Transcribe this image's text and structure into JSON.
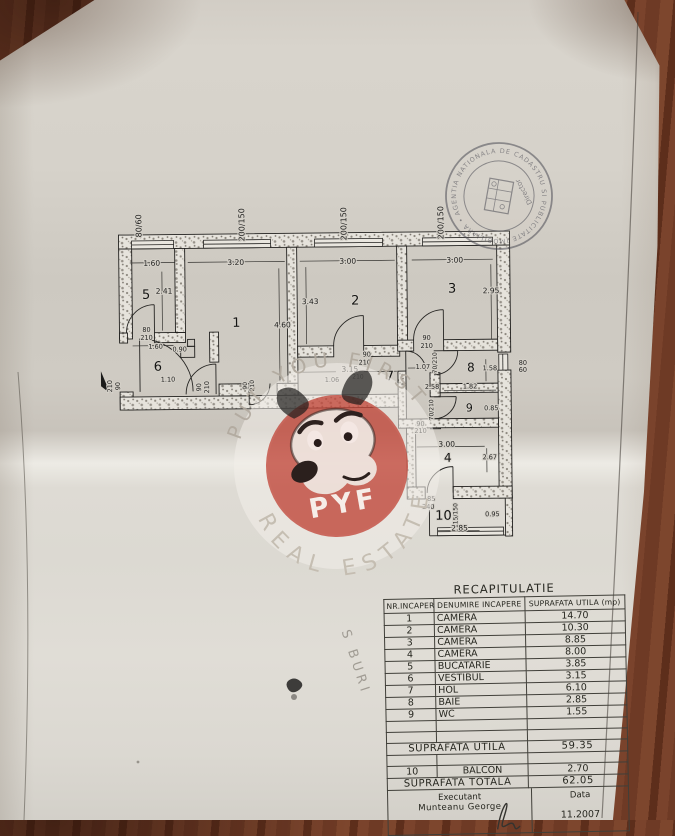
{
  "plan": {
    "labels": [
      {
        "t": "80/60",
        "x": 143,
        "y": 224,
        "r": -90,
        "s": 8
      },
      {
        "t": "200/150",
        "x": 246,
        "y": 224,
        "r": -90,
        "s": 8
      },
      {
        "t": "200/150",
        "x": 348,
        "y": 224,
        "r": -90,
        "s": 8
      },
      {
        "t": "200/150",
        "x": 445,
        "y": 224,
        "r": -90,
        "s": 8
      },
      {
        "t": "5",
        "x": 147,
        "y": 297,
        "s": 13,
        "cls": "num"
      },
      {
        "t": "1",
        "x": 237,
        "y": 326,
        "s": 13,
        "cls": "num"
      },
      {
        "t": "2",
        "x": 356,
        "y": 305,
        "s": 13,
        "cls": "num"
      },
      {
        "t": "3",
        "x": 453,
        "y": 294,
        "s": 13,
        "cls": "num"
      },
      {
        "t": "6",
        "x": 158,
        "y": 369,
        "s": 13,
        "cls": "num"
      },
      {
        "t": "7",
        "x": 390,
        "y": 381,
        "s": 13,
        "cls": "num"
      },
      {
        "t": "8",
        "x": 471,
        "y": 373,
        "s": 12,
        "cls": "num"
      },
      {
        "t": "9",
        "x": 469,
        "y": 413,
        "s": 11,
        "cls": "num"
      },
      {
        "t": "4",
        "x": 447,
        "y": 463,
        "s": 12,
        "cls": "num"
      },
      {
        "t": "10",
        "x": 442,
        "y": 521,
        "s": 13,
        "cls": "num"
      },
      {
        "t": "1.60",
        "x": 153,
        "y": 264
      },
      {
        "t": "3.20",
        "x": 237,
        "y": 264
      },
      {
        "t": "3.00",
        "x": 349,
        "y": 264
      },
      {
        "t": "3.00",
        "x": 456,
        "y": 264
      },
      {
        "t": "2.41",
        "x": 165,
        "y": 292
      },
      {
        "t": "4.60",
        "x": 283,
        "y": 327
      },
      {
        "t": "3.43",
        "x": 311,
        "y": 304
      },
      {
        "t": "2.95",
        "x": 492,
        "y": 295
      },
      {
        "t": "80",
        "x": 147,
        "y": 330,
        "s": 6.5
      },
      {
        "t": "210",
        "x": 147,
        "y": 338,
        "s": 6.5
      },
      {
        "t": "1.60",
        "x": 156,
        "y": 347,
        "s": 6.5
      },
      {
        "t": "0.90",
        "x": 180,
        "y": 350,
        "s": 6.5
      },
      {
        "t": "1.10",
        "x": 168,
        "y": 380,
        "s": 6.5
      },
      {
        "t": "90",
        "x": 120,
        "y": 384,
        "r": -90,
        "s": 6.5
      },
      {
        "t": "210",
        "x": 112,
        "y": 384,
        "r": -90,
        "s": 6.5
      },
      {
        "t": "90",
        "x": 201,
        "y": 386,
        "r": -90,
        "s": 6.5
      },
      {
        "t": "210",
        "x": 209,
        "y": 386,
        "r": -90,
        "s": 6.5
      },
      {
        "t": "90",
        "x": 247,
        "y": 385,
        "r": -90,
        "s": 6
      },
      {
        "t": "210",
        "x": 254,
        "y": 385,
        "r": -90,
        "s": 6
      },
      {
        "t": "3.15",
        "x": 350,
        "y": 372
      },
      {
        "t": "210",
        "x": 358,
        "y": 379,
        "s": 6
      },
      {
        "t": "1.06",
        "x": 332,
        "y": 382,
        "s": 6.5
      },
      {
        "t": "90",
        "x": 367,
        "y": 357,
        "s": 6.5
      },
      {
        "t": "210",
        "x": 365,
        "y": 365,
        "s": 6.5
      },
      {
        "t": "1.07",
        "x": 423,
        "y": 370,
        "s": 6.5
      },
      {
        "t": "2.58",
        "x": 432,
        "y": 390,
        "s": 6.5
      },
      {
        "t": "90",
        "x": 427,
        "y": 341,
        "s": 6.5
      },
      {
        "t": "210",
        "x": 427,
        "y": 349,
        "s": 6.5
      },
      {
        "t": "70/210",
        "x": 437,
        "y": 364,
        "r": -90,
        "s": 6
      },
      {
        "t": "1.58",
        "x": 490,
        "y": 372,
        "s": 6.5
      },
      {
        "t": "1.82",
        "x": 470,
        "y": 390,
        "s": 6.5
      },
      {
        "t": "80",
        "x": 523,
        "y": 367,
        "s": 6.5
      },
      {
        "t": "60",
        "x": 523,
        "y": 374,
        "s": 6.5
      },
      {
        "t": "0.85",
        "x": 491,
        "y": 412,
        "s": 6.5
      },
      {
        "t": "70/210",
        "x": 433,
        "y": 411,
        "r": -90,
        "s": 6
      },
      {
        "t": "90",
        "x": 420,
        "y": 427,
        "s": 6.5
      },
      {
        "t": "210",
        "x": 420,
        "y": 434,
        "s": 6.5
      },
      {
        "t": "3.00",
        "x": 446,
        "y": 448
      },
      {
        "t": "2.67",
        "x": 489,
        "y": 461,
        "s": 6.5
      },
      {
        "t": "85",
        "x": 430,
        "y": 502,
        "s": 6.5
      },
      {
        "t": "240",
        "x": 427,
        "y": 510,
        "s": 6.5
      },
      {
        "t": "115/150",
        "x": 456,
        "y": 517,
        "r": -90,
        "s": 6
      },
      {
        "t": "0.95",
        "x": 491,
        "y": 518,
        "s": 6.5
      },
      {
        "t": "2.85",
        "x": 458,
        "y": 532
      }
    ]
  },
  "table": {
    "title": "RECAPITULATIE",
    "headers": [
      "NR.INCAPERE",
      "DENUMIRE INCAPERE",
      "SUPRAFATA UTILA (mp)"
    ],
    "rows": [
      [
        "1",
        "CAMERA",
        "14.70"
      ],
      [
        "2",
        "CAMERA",
        "10.30"
      ],
      [
        "3",
        "CAMERA",
        "8.85"
      ],
      [
        "4",
        "CAMERA",
        "8.00"
      ],
      [
        "5",
        "BUCATARIE",
        "3.85"
      ],
      [
        "6",
        "VESTIBUL",
        "3.15"
      ],
      [
        "7",
        "HOL",
        "6.10"
      ],
      [
        "8",
        "BAIE",
        "2.85"
      ],
      [
        "9",
        "WC",
        "1.55"
      ]
    ],
    "subtotal_label": "SUPRAFATA UTILA",
    "subtotal_value": "59.35",
    "balcony_row": [
      "10",
      "BALCON",
      "2.70"
    ],
    "total_label": "SUPRAFATA TOTALA",
    "total_value": "62.05",
    "executant_label": "Executant",
    "executant_name": "Munteanu George",
    "date_label": "Data",
    "date_value": "11.2007"
  },
  "stamp": {
    "arc_text": "AGENTIA NATIONALA DE CADASTRU SI PUBLICITATE IMOBILIARA • AL MUN. •",
    "center_text": "Director"
  },
  "watermark": {
    "arc_top": "PUT YOU FIRST",
    "arc_bottom": "REAL ESTATE",
    "monogram": "PYF",
    "circle_color": "#c2473a"
  },
  "annotations": {
    "handwriting": "S BURI"
  }
}
